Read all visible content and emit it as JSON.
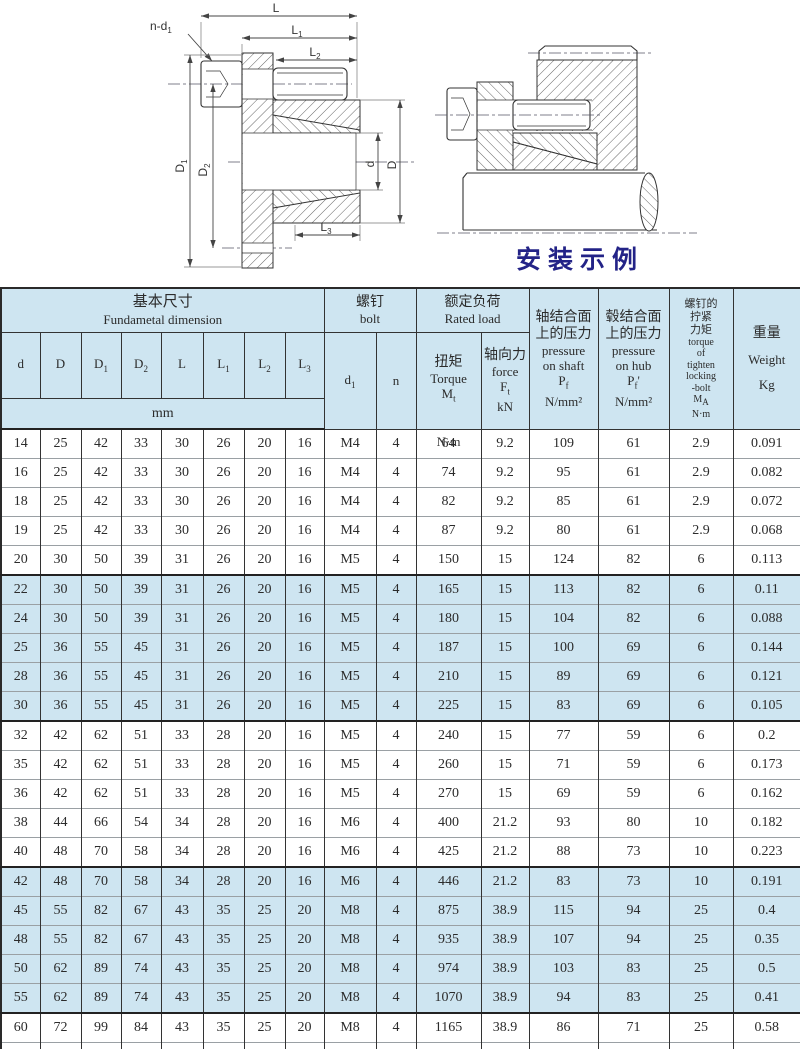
{
  "page": {
    "accent_caption_color": "#232387",
    "table_highlight_color": "#cee5f1"
  },
  "drawings": {
    "left": {
      "labels": {
        "L": {
          "b": "L",
          "s": ""
        },
        "L1": {
          "b": "L",
          "s": "1"
        },
        "L2": {
          "b": "L",
          "s": "2"
        },
        "L3": {
          "b": "L",
          "s": "3"
        },
        "nd1": {
          "b": "n-d",
          "s": "1"
        },
        "D1": {
          "b": "D",
          "s": "1"
        },
        "D2": {
          "b": "D",
          "s": "2"
        },
        "d": {
          "b": "d",
          "s": ""
        },
        "D": {
          "b": "D",
          "s": ""
        }
      }
    },
    "right": {
      "caption": "安装示例"
    }
  },
  "table": {
    "header": {
      "basic": {
        "zh": "基本尺寸",
        "en": "Fundametal dimension"
      },
      "bolt": {
        "zh": "螺钉",
        "en": "bolt"
      },
      "rated": {
        "zh": "额定负荷",
        "en": "Rated load"
      },
      "cols": [
        {
          "b": "d",
          "s": ""
        },
        {
          "b": "D",
          "s": ""
        },
        {
          "b": "D",
          "s": "1"
        },
        {
          "b": "D",
          "s": "2"
        },
        {
          "b": "L",
          "s": ""
        },
        {
          "b": "L",
          "s": "1"
        },
        {
          "b": "L",
          "s": "2"
        },
        {
          "b": "L",
          "s": "3"
        }
      ],
      "unit_mm": "mm",
      "d1": {
        "b": "d",
        "s": "1"
      },
      "n": "n",
      "torque": {
        "zh": "扭矩",
        "en": "Torque",
        "sym": "M",
        "sub": "t",
        "unit": "N·m"
      },
      "force": {
        "zh": "轴向力",
        "en": "force",
        "sym": "F",
        "sub": "t",
        "unit": "kN"
      },
      "pshaft": {
        "zh1": "轴结合面",
        "zh2": "上的压力",
        "en1": "pressure",
        "en2": "on shaft",
        "sym": "P",
        "sub": "f",
        "suffix": "",
        "unit": "N/mm²"
      },
      "phub": {
        "zh1": "毂结合面",
        "zh2": "上的压力",
        "en1": "pressure",
        "en2": "on hub",
        "sym": "P",
        "sub": "f",
        "suffix": "'",
        "unit": "N/mm²"
      },
      "ma": {
        "zh1": "螺钉的",
        "zh2": "拧紧",
        "zh3": "力矩",
        "en1": "torque",
        "en2": "of",
        "en3": "tighten",
        "en4": "locking",
        "en5": "-bolt",
        "sym": "M",
        "sub": "A",
        "unit": "N·m"
      },
      "weight": {
        "zh": "重量",
        "en": "Weight",
        "unit": "Kg"
      }
    },
    "rows": [
      [
        "14",
        "25",
        "42",
        "33",
        "30",
        "26",
        "20",
        "16",
        "M4",
        "4",
        "64",
        "9.2",
        "109",
        "61",
        "2.9",
        "0.091"
      ],
      [
        "16",
        "25",
        "42",
        "33",
        "30",
        "26",
        "20",
        "16",
        "M4",
        "4",
        "74",
        "9.2",
        "95",
        "61",
        "2.9",
        "0.082"
      ],
      [
        "18",
        "25",
        "42",
        "33",
        "30",
        "26",
        "20",
        "16",
        "M4",
        "4",
        "82",
        "9.2",
        "85",
        "61",
        "2.9",
        "0.072"
      ],
      [
        "19",
        "25",
        "42",
        "33",
        "30",
        "26",
        "20",
        "16",
        "M4",
        "4",
        "87",
        "9.2",
        "80",
        "61",
        "2.9",
        "0.068"
      ],
      [
        "20",
        "30",
        "50",
        "39",
        "31",
        "26",
        "20",
        "16",
        "M5",
        "4",
        "150",
        "15",
        "124",
        "82",
        "6",
        "0.113"
      ],
      [
        "22",
        "30",
        "50",
        "39",
        "31",
        "26",
        "20",
        "16",
        "M5",
        "4",
        "165",
        "15",
        "113",
        "82",
        "6",
        "0.11"
      ],
      [
        "24",
        "30",
        "50",
        "39",
        "31",
        "26",
        "20",
        "16",
        "M5",
        "4",
        "180",
        "15",
        "104",
        "82",
        "6",
        "0.088"
      ],
      [
        "25",
        "36",
        "55",
        "45",
        "31",
        "26",
        "20",
        "16",
        "M5",
        "4",
        "187",
        "15",
        "100",
        "69",
        "6",
        "0.144"
      ],
      [
        "28",
        "36",
        "55",
        "45",
        "31",
        "26",
        "20",
        "16",
        "M5",
        "4",
        "210",
        "15",
        "89",
        "69",
        "6",
        "0.121"
      ],
      [
        "30",
        "36",
        "55",
        "45",
        "31",
        "26",
        "20",
        "16",
        "M5",
        "4",
        "225",
        "15",
        "83",
        "69",
        "6",
        "0.105"
      ],
      [
        "32",
        "42",
        "62",
        "51",
        "33",
        "28",
        "20",
        "16",
        "M5",
        "4",
        "240",
        "15",
        "77",
        "59",
        "6",
        "0.2"
      ],
      [
        "35",
        "42",
        "62",
        "51",
        "33",
        "28",
        "20",
        "16",
        "M5",
        "4",
        "260",
        "15",
        "71",
        "59",
        "6",
        "0.173"
      ],
      [
        "36",
        "42",
        "62",
        "51",
        "33",
        "28",
        "20",
        "16",
        "M5",
        "4",
        "270",
        "15",
        "69",
        "59",
        "6",
        "0.162"
      ],
      [
        "38",
        "44",
        "66",
        "54",
        "34",
        "28",
        "20",
        "16",
        "M6",
        "4",
        "400",
        "21.2",
        "93",
        "80",
        "10",
        "0.182"
      ],
      [
        "40",
        "48",
        "70",
        "58",
        "34",
        "28",
        "20",
        "16",
        "M6",
        "4",
        "425",
        "21.2",
        "88",
        "73",
        "10",
        "0.223"
      ],
      [
        "42",
        "48",
        "70",
        "58",
        "34",
        "28",
        "20",
        "16",
        "M6",
        "4",
        "446",
        "21.2",
        "83",
        "73",
        "10",
        "0.191"
      ],
      [
        "45",
        "55",
        "82",
        "67",
        "43",
        "35",
        "25",
        "20",
        "M8",
        "4",
        "875",
        "38.9",
        "115",
        "94",
        "25",
        "0.4"
      ],
      [
        "48",
        "55",
        "82",
        "67",
        "43",
        "35",
        "25",
        "20",
        "M8",
        "4",
        "935",
        "38.9",
        "107",
        "94",
        "25",
        "0.35"
      ],
      [
        "50",
        "62",
        "89",
        "74",
        "43",
        "35",
        "25",
        "20",
        "M8",
        "4",
        "974",
        "38.9",
        "103",
        "83",
        "25",
        "0.5"
      ],
      [
        "55",
        "62",
        "89",
        "74",
        "43",
        "35",
        "25",
        "20",
        "M8",
        "4",
        "1070",
        "38.9",
        "94",
        "83",
        "25",
        "0.41"
      ],
      [
        "60",
        "72",
        "99",
        "84",
        "43",
        "35",
        "25",
        "20",
        "M8",
        "4",
        "1165",
        "38.9",
        "86",
        "71",
        "25",
        "0.58"
      ],
      [
        "65",
        "72",
        "99",
        "84",
        "43",
        "35",
        "25",
        "20",
        "M8",
        "4",
        "1265",
        "38.9",
        "79",
        "71",
        "25",
        "0.46"
      ]
    ],
    "shaded_row_indices": [
      5,
      6,
      7,
      8,
      9,
      15,
      16,
      17,
      18,
      19
    ],
    "group_start_indices": [
      5,
      10,
      15,
      20
    ]
  }
}
